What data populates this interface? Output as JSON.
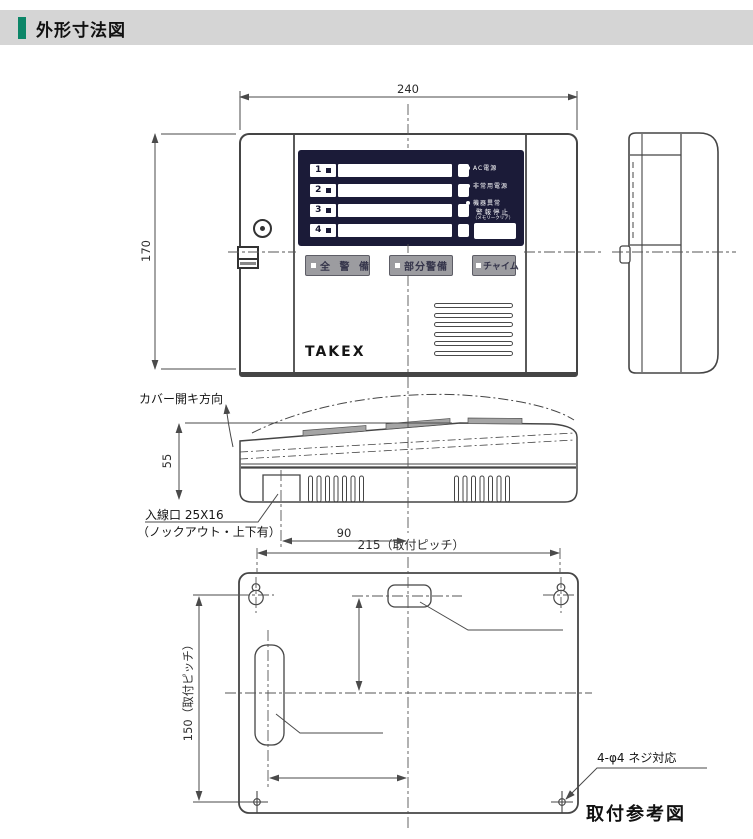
{
  "header": {
    "title": "外形寸法図",
    "accent_color": "#0c8668"
  },
  "dims": {
    "w240": "240",
    "h170": "170",
    "h55": "55",
    "d90": "90",
    "p215": "215（取付ピッチ）",
    "p150": "150（取付ピッチ）",
    "v69": "69",
    "h99": "99"
  },
  "front": {
    "logo": "TAKEX",
    "zones": [
      "1",
      "2",
      "3",
      "4"
    ],
    "leds": [
      "AC電源",
      "非常用電源",
      "機器異常"
    ],
    "alarm_stop": "警報停止",
    "memory_clear": "（メモリークリア）",
    "buttons": [
      "全 警 備",
      "部分警備",
      "チャイム"
    ],
    "panel_color": "#1b1b38"
  },
  "profile": {
    "cover_open": "カバー開キ方向",
    "inlet1": "入線口 25X16",
    "inlet1_note": "（ノックアウト・上下有）"
  },
  "mount": {
    "inlet_top": "入線口 30X15",
    "inlet_top_note": "（ノックアウト）",
    "inlet_left": "入線口 20X70",
    "screw_note": "4-φ4 ネジ対応",
    "caption": "取付参考図"
  }
}
